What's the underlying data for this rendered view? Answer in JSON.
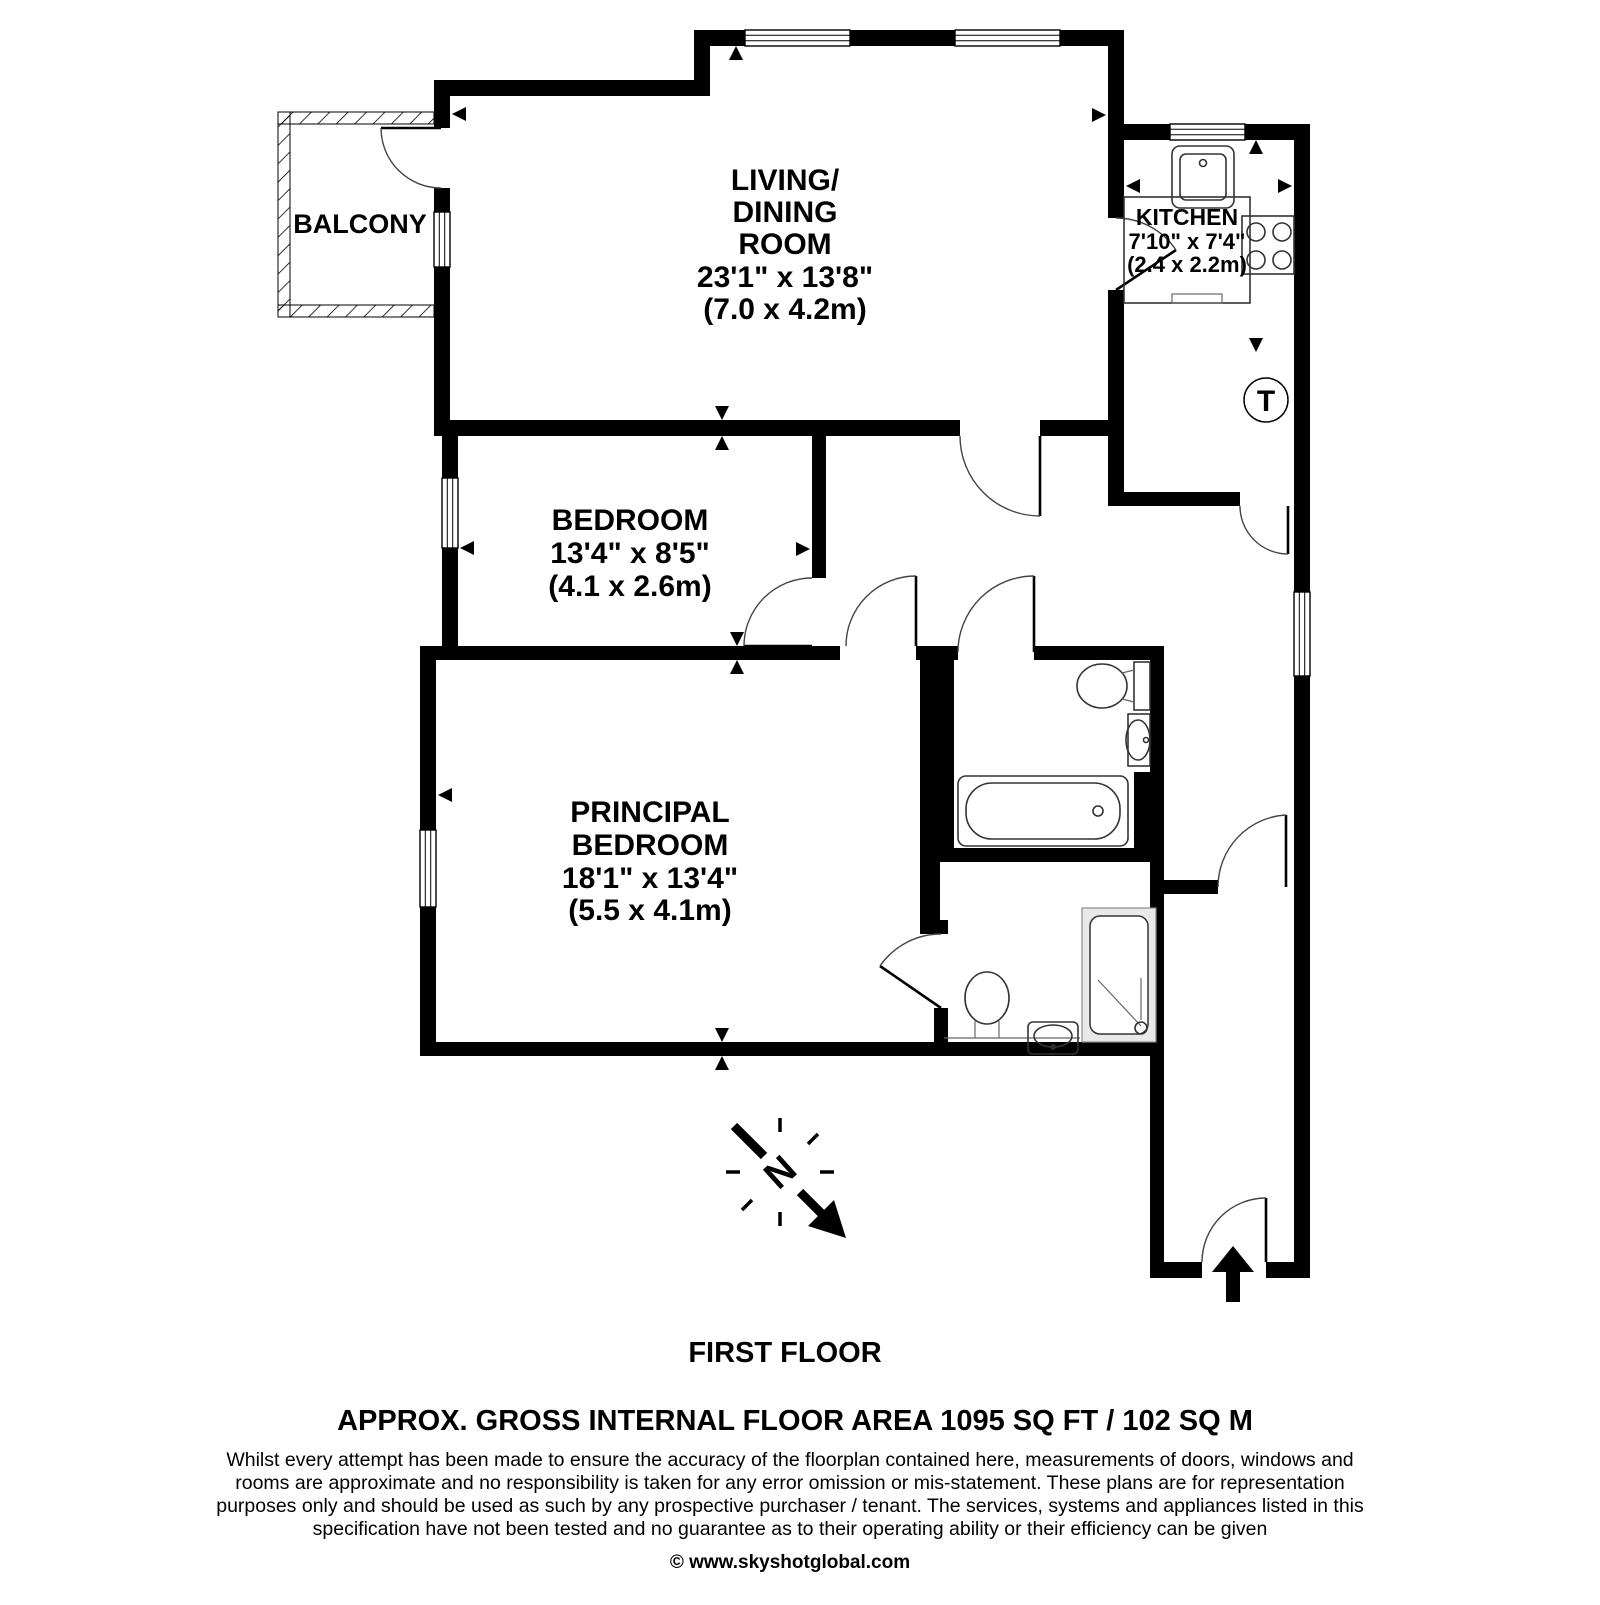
{
  "title": {
    "floor": "FIRST FLOOR",
    "area": "APPROX. GROSS INTERNAL FLOOR AREA 1095 SQ FT / 102 SQ M"
  },
  "rooms": {
    "balcony": {
      "name": "BALCONY"
    },
    "living_dining": {
      "line1": "LIVING/",
      "line2": "DINING",
      "line3": "ROOM",
      "imperial": "23'1\" x 13'8\"",
      "metric": "(7.0 x 4.2m)"
    },
    "kitchen": {
      "name": "KITCHEN",
      "imperial": "7'10\" x 7'4\"",
      "metric": "(2.4 x 2.2m)"
    },
    "bedroom": {
      "name": "BEDROOM",
      "imperial": "13'4\" x 8'5\"",
      "metric": "(4.1 x 2.6m)"
    },
    "principal_bedroom": {
      "line1": "PRINCIPAL",
      "line2": "BEDROOM",
      "imperial": "18'1\" x 13'4\"",
      "metric": "(5.5 x 4.1m)"
    }
  },
  "symbols": {
    "tank": "T",
    "north": "N"
  },
  "footer": {
    "disclaimer_lines": [
      "Whilst every attempt has been made to ensure the accuracy of the floorplan contained here, measurements of doors, windows and",
      "rooms are approximate and no responsibility is taken for any error omission or mis-statement. These plans are for representation",
      "purposes only and should  be used as such by any prospective purchaser / tenant. The services, systems and appliances listed in this",
      "specification have not been tested and no guarantee as to their operating ability or their efficiency can be given"
    ],
    "copyright": "© www.skyshotglobal.com"
  },
  "colors": {
    "wall": "#000000",
    "background": "#ffffff"
  }
}
